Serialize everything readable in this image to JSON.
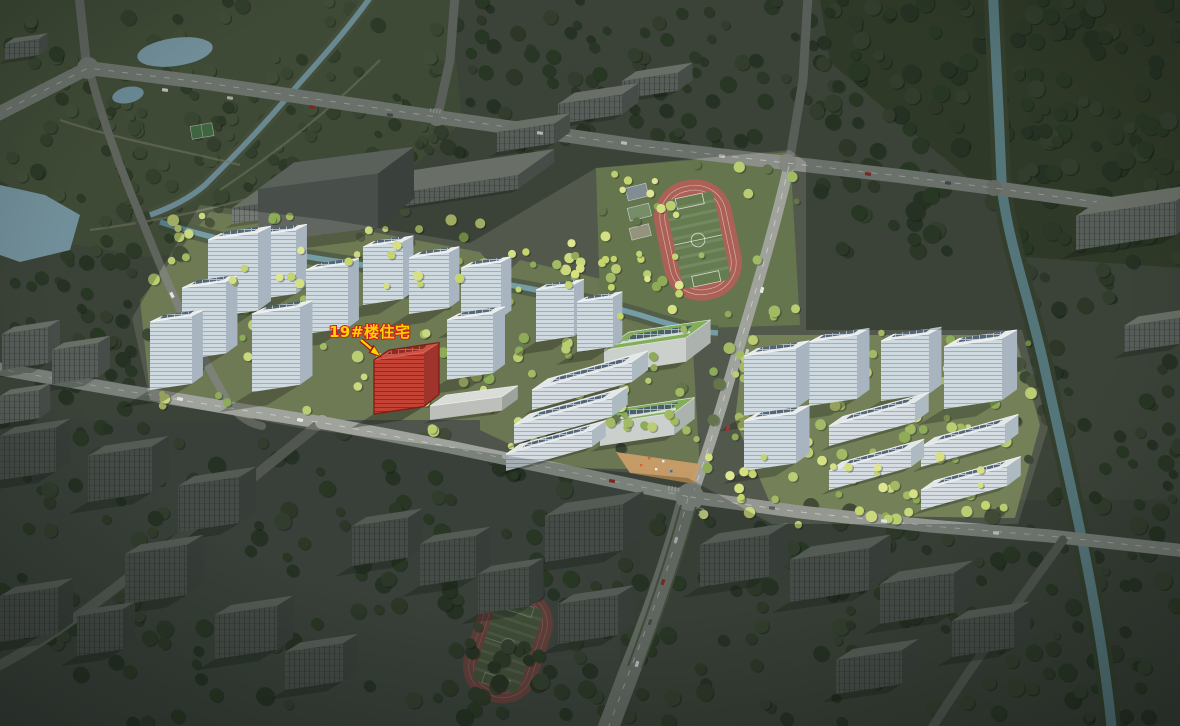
{
  "annotation": {
    "text": "19#楼住宅",
    "pointer": "arrow-to-highlighted-building"
  },
  "colors": {
    "highlight_building": "#c0392b",
    "highlight_outline": "#7a120c",
    "label_text": "#ffd300",
    "label_outline": "#d0201a",
    "track_red": "#a85a50",
    "field_green": "#5d7749",
    "water": "#6e99a4",
    "road_bright": "#9aa099",
    "road_dark": "#6b706b",
    "tree_bright": "#b8cc6d",
    "tree_dark": "#36422f",
    "tower_facade": "#cdd9e1",
    "context_building": "#6e736e"
  }
}
